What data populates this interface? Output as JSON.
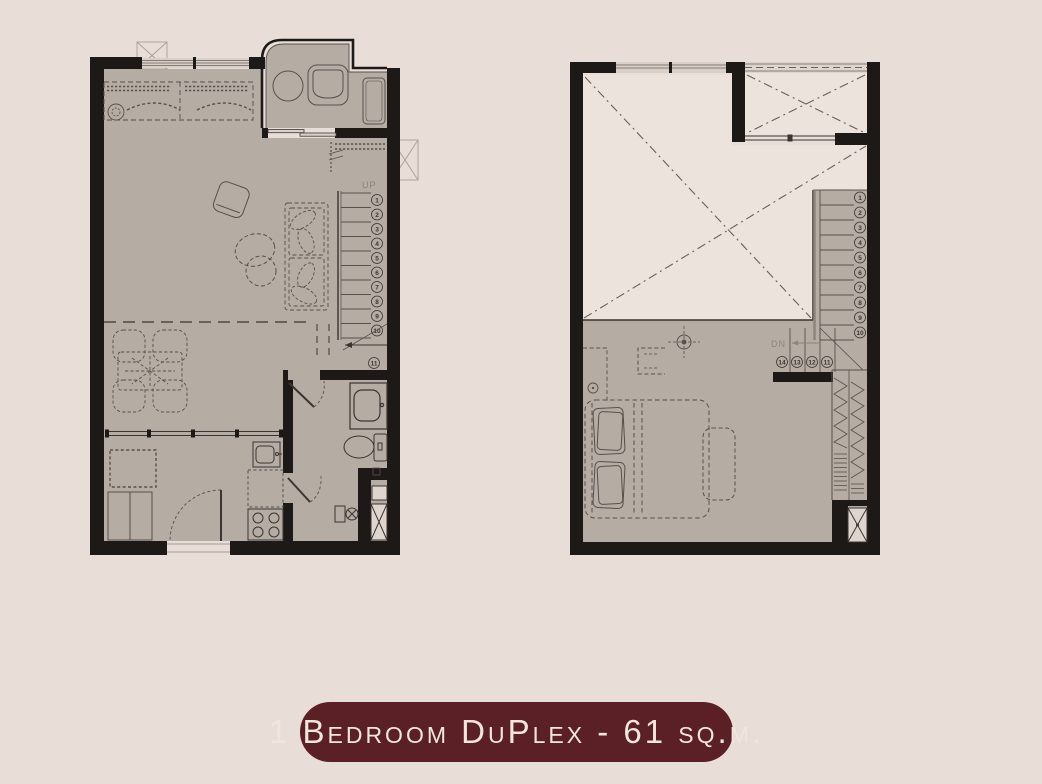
{
  "colors": {
    "background": "#e8ded7",
    "wall": "#1d1917",
    "floor": "#b5aca4",
    "void_fill": "#ece3dc",
    "window_fill": "#d9d0c9",
    "linework": "#57514b",
    "light_linework": "#8d857c",
    "badge_bg": "#5a2026",
    "badge_text": "#f1e5de"
  },
  "badge": {
    "label": "1 Bedroom DuPlex - 61 sq.m."
  },
  "plans": {
    "first_floor": {
      "up_label": "UP",
      "stair_numbers": [
        "1",
        "2",
        "3",
        "4",
        "5",
        "6",
        "7",
        "8",
        "9",
        "10",
        "11"
      ]
    },
    "second_floor": {
      "dn_label": "DN",
      "stair_numbers_up": [
        "1",
        "2",
        "3",
        "4",
        "5",
        "6",
        "7",
        "8",
        "9",
        "10"
      ],
      "stair_numbers_landing": [
        "14",
        "13",
        "12",
        "11"
      ]
    }
  }
}
